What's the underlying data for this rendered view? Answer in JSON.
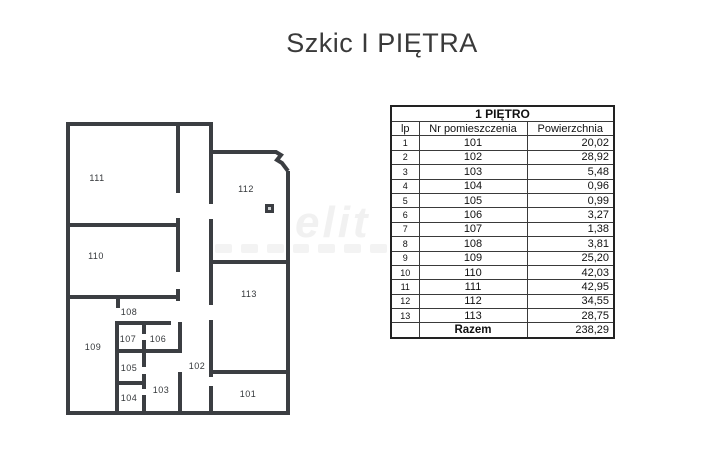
{
  "page": {
    "title": "Szkic I PIĘTRA",
    "background_color": "#ffffff"
  },
  "watermark": {
    "text": "elit",
    "color": "#f1f1f1"
  },
  "floorplan": {
    "wall_color": "#3b3e42",
    "door_marker": "dark-square",
    "rooms": [
      {
        "label": "111"
      },
      {
        "label": "112"
      },
      {
        "label": "110"
      },
      {
        "label": "113"
      },
      {
        "label": "108"
      },
      {
        "label": "107"
      },
      {
        "label": "106"
      },
      {
        "label": "109"
      },
      {
        "label": "105"
      },
      {
        "label": "102"
      },
      {
        "label": "103"
      },
      {
        "label": "104"
      },
      {
        "label": "101"
      }
    ]
  },
  "table": {
    "title": "1 PIĘTRO",
    "columns": [
      "lp",
      "Nr pomieszczenia",
      "Powierzchnia"
    ],
    "rows": [
      {
        "lp": "1",
        "room": "101",
        "area": "20,02"
      },
      {
        "lp": "2",
        "room": "102",
        "area": "28,92"
      },
      {
        "lp": "3",
        "room": "103",
        "area": "5,48"
      },
      {
        "lp": "4",
        "room": "104",
        "area": "0,96"
      },
      {
        "lp": "5",
        "room": "105",
        "area": "0,99"
      },
      {
        "lp": "6",
        "room": "106",
        "area": "3,27"
      },
      {
        "lp": "7",
        "room": "107",
        "area": "1,38"
      },
      {
        "lp": "8",
        "room": "108",
        "area": "3,81"
      },
      {
        "lp": "9",
        "room": "109",
        "area": "25,20"
      },
      {
        "lp": "10",
        "room": "110",
        "area": "42,03"
      },
      {
        "lp": "11",
        "room": "111",
        "area": "42,95"
      },
      {
        "lp": "12",
        "room": "112",
        "area": "34,55"
      },
      {
        "lp": "13",
        "room": "113",
        "area": "28,75"
      }
    ],
    "total_label": "Razem",
    "total_area": "238,29"
  }
}
